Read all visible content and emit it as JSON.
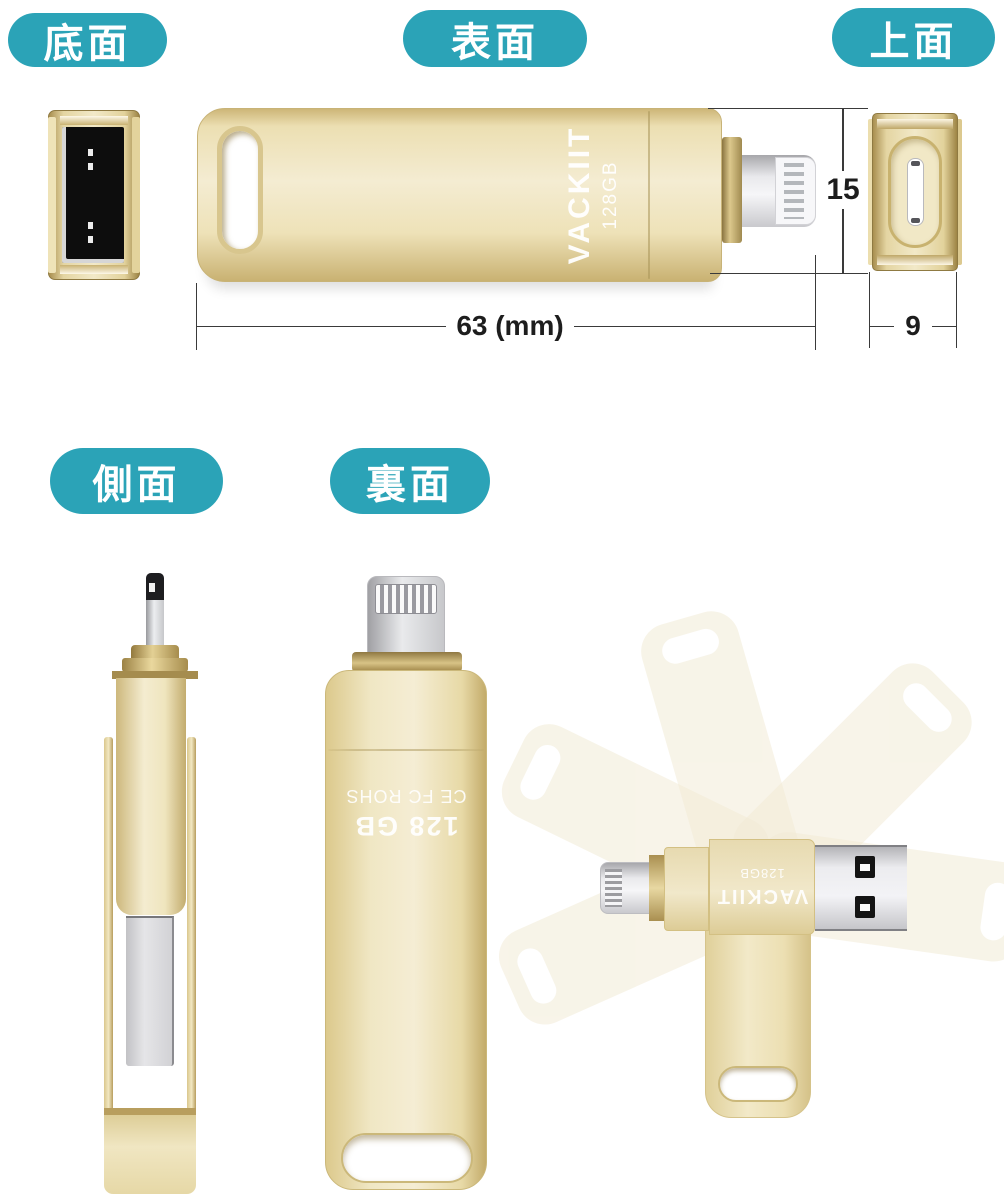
{
  "colors": {
    "accent_teal": "#2ba3b7",
    "gold": "#eee3bc",
    "gold_dark": "#b89d5e",
    "silver": "#d9d9dc",
    "socket_black": "#0d0d0d",
    "background": "#ffffff"
  },
  "view_labels": {
    "bottom": "底面",
    "front": "表面",
    "top": "上面",
    "side": "側面",
    "back": "裏面"
  },
  "front_view": {
    "brand": "VACKIIT",
    "capacity": "128GB"
  },
  "back_view": {
    "capacity": "128 GB",
    "certifications": "CE FC ROHS"
  },
  "rotation_view": {
    "brand": "VACKIIT",
    "capacity": "128GB"
  },
  "dimensions": {
    "length_mm": "63 (mm)",
    "height_mm": "15",
    "width_mm": "9"
  }
}
